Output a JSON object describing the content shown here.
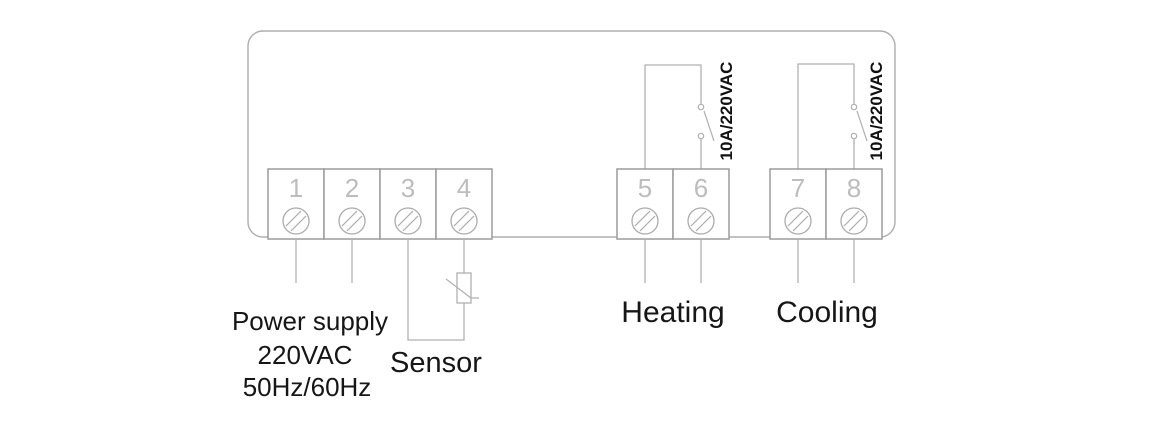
{
  "diagram": {
    "type": "wiring-diagram"
  },
  "terminals": [
    {
      "number": "1"
    },
    {
      "number": "2"
    },
    {
      "number": "3"
    },
    {
      "number": "4"
    },
    {
      "number": "5"
    },
    {
      "number": "6"
    },
    {
      "number": "7"
    },
    {
      "number": "8"
    }
  ],
  "relays": [
    {
      "rating": "10A/220VAC",
      "output_label": "Heating"
    },
    {
      "rating": "10A/220VAC",
      "output_label": "Cooling"
    }
  ],
  "labels": {
    "power_supply_line1": "Power supply",
    "power_supply_line2": "220VAC",
    "power_supply_line3": "50Hz/60Hz",
    "sensor": "Sensor",
    "heating": "Heating",
    "cooling": "Cooling"
  },
  "colors": {
    "background": "#ffffff",
    "line_gray": "#b0b0b0",
    "terminal_border_gray": "#9c9c9c",
    "terminal_number_gray": "#bdbdbd",
    "label_black": "#161616"
  }
}
